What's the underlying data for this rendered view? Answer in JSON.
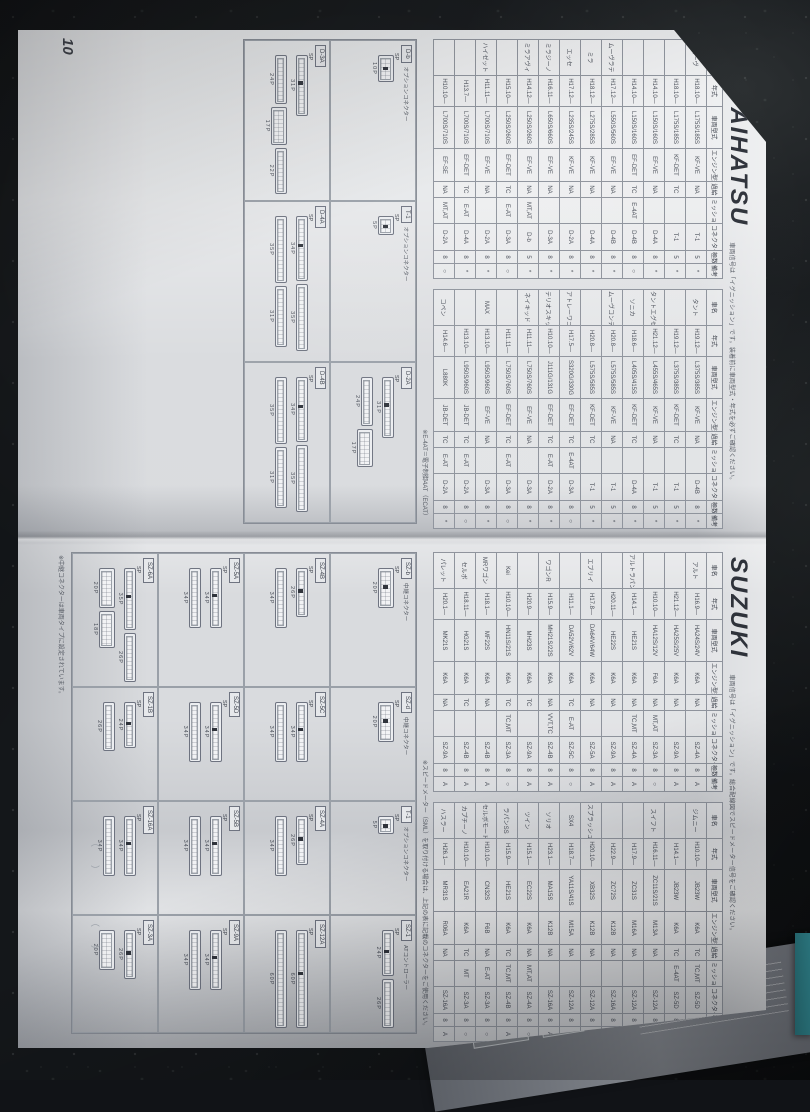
{
  "page": {
    "number": "10",
    "sections": [
      {
        "brand": "DAIHATSU",
        "note": "車両信号は「イグニッション」です。装着前に車両型式・年式を必ずご確認ください。",
        "columns": [
          "車名",
          "年式",
          "車両型式",
          "エンジン型式",
          "過給",
          "ミッション",
          "コネクター",
          "極数",
          "備考"
        ],
        "blocks": [
          [
            [
              "ムーヴ",
              "H18.10—",
              "L175S/185S",
              "KF-VE",
              "NA",
              "",
              "T-1",
              "5",
              "*"
            ],
            [
              "",
              "H18.10—",
              "L175S/185S",
              "KF-DET",
              "TC",
              "",
              "T-1",
              "5",
              "*"
            ],
            [
              "",
              "H14.10—",
              "L150S/160S",
              "EF-VE",
              "NA",
              "",
              "D-4A",
              "8",
              "*"
            ],
            [
              "",
              "H14.10—",
              "L150S/160S",
              "EF-DET",
              "TC",
              "E-4AT",
              "D-4B",
              "8",
              "○"
            ],
            [
              "ムーヴラテ",
              "H17.12—",
              "L550S/560S",
              "EF-VE",
              "NA",
              "",
              "D-4B",
              "8",
              "*"
            ],
            [
              "ミラ",
              "H18.12—",
              "L275S/285S",
              "KF-VE",
              "NA",
              "",
              "D-4A",
              "8",
              "*"
            ],
            [
              "エッセ",
              "H17.12—",
              "L235S/245S",
              "KF-VE",
              "NA",
              "",
              "D-2A",
              "8",
              "*"
            ],
            [
              "ミラジーノ",
              "H16.11—",
              "L650S/660S",
              "EF-VE",
              "NA",
              "",
              "D-3A",
              "8",
              "*"
            ],
            [
              "ミラアヴィ",
              "H14.12—",
              "L250S/260S",
              "EF-VE",
              "NA",
              "MT,AT",
              "D-b",
              "5",
              "*"
            ],
            [
              "",
              "H15.10—",
              "L250S/260S",
              "EF-DET",
              "TC",
              "E-AT",
              "D-3A",
              "8",
              "○"
            ],
            [
              "ハイゼット",
              "H11.11—",
              "L700S/710S",
              "EF-VE",
              "NA",
              "",
              "D-2A",
              "8",
              "*"
            ],
            [
              "",
              "H13.7—",
              "L700S/710S",
              "EF-DET",
              "TC",
              "E-AT",
              "D-4A",
              "8",
              "*"
            ],
            [
              "",
              "H10.10—",
              "L700S/710S",
              "EF-SE",
              "NA",
              "MT,AT",
              "D-2A",
              "8",
              "○"
            ]
          ],
          [
            [
              "タント",
              "H19.12—",
              "L375S/385S",
              "KF-VE",
              "NA",
              "",
              "D-4B",
              "8",
              "*"
            ],
            [
              "",
              "H19.12—",
              "L375S/385S",
              "KF-DET",
              "TC",
              "",
              "T-1",
              "5",
              "*"
            ],
            [
              "タントエグゼ",
              "H21.12—",
              "L455S/465S",
              "KF-VE",
              "NA",
              "",
              "T-1",
              "5",
              "*"
            ],
            [
              "ソニカ",
              "H18.6—",
              "L405S/415S",
              "KF-DET",
              "TC",
              "",
              "D-4A",
              "8",
              "*"
            ],
            [
              "ムーヴコンテ",
              "H20.8—",
              "L575S/585S",
              "KF-VE",
              "NA",
              "",
              "T-1",
              "5",
              "*"
            ],
            [
              "",
              "H20.8—",
              "L575S/585S",
              "KF-DET",
              "TC",
              "",
              "T-1",
              "5",
              "*"
            ],
            [
              "アトレーワゴン",
              "H17.5—",
              "S320G/330G",
              "EF-DET",
              "TC",
              "E-4AT",
              "D-3A",
              "8",
              "○"
            ],
            [
              "テリオスキッド",
              "H10.10—",
              "J111G/131G",
              "EF-DET",
              "TC",
              "E-AT",
              "D-2A",
              "8",
              "*"
            ],
            [
              "ネイキッド",
              "H11.11—",
              "L750S/760S",
              "EF-VE",
              "NA",
              "",
              "D-3A",
              "8",
              "*"
            ],
            [
              "",
              "H11.11—",
              "L750S/760S",
              "EF-DET",
              "TC",
              "E-AT",
              "D-3A",
              "8",
              "○"
            ],
            [
              "MAX",
              "H13.10—",
              "L950S/960S",
              "EF-VE",
              "NA",
              "",
              "D-3A",
              "8",
              "*"
            ],
            [
              "",
              "H13.10—",
              "L950S/960S",
              "JB-DET",
              "TC",
              "E-AT",
              "D-2A",
              "8",
              "○"
            ],
            [
              "コペン",
              "H14.6—",
              "L880K",
              "JB-DET",
              "TC",
              "E-AT",
              "D-2A",
              "8",
              "*"
            ]
          ]
        ],
        "footnote": "※E-4AT＝電子制御4AT（ECAT）",
        "panels": [
          {
            "id": "D-b",
            "sub": "オプションコネクター",
            "rows": [
              [
                "10P"
              ]
            ],
            "sp": "SP"
          },
          {
            "id": "T-1",
            "sub": "オプションコネクター",
            "rows": [
              [
                "5P"
              ]
            ],
            "sp": "SP"
          },
          {
            "id": "D-2A",
            "sub": "",
            "rows": [
              [
                "31P"
              ],
              [
                "24P",
                "17P"
              ]
            ],
            "sp": "SP"
          },
          {
            "id": "D-3A",
            "sub": "",
            "rows": [
              [
                "31P"
              ],
              [
                "24P",
                "17P",
                "22P"
              ]
            ],
            "sp": "SP"
          },
          {
            "id": "D-4A",
            "sub": "",
            "rows": [
              [
                "34P",
                "35P"
              ],
              [
                "35P",
                "31P"
              ]
            ],
            "sp": "SP"
          },
          {
            "id": "D-4B",
            "sub": "",
            "rows": [
              [
                "34P",
                "35P"
              ],
              [
                "35P",
                "31P"
              ]
            ],
            "sp": "SP"
          }
        ]
      },
      {
        "brand": "SUZUKI",
        "note": "車両信号は「イグニッション」です。総合配線図でスピードメーター信号をご確認ください。",
        "columns": [
          "車名",
          "年式",
          "車両型式",
          "エンジン型式",
          "過給",
          "ミッション",
          "コネクター",
          "極数",
          "備考"
        ],
        "blocks": [
          [
            [
              "アルト",
              "H16.9—",
              "HA24S/24V",
              "K6A",
              "NA",
              "",
              "SZ-4A",
              "8",
              "A"
            ],
            [
              "",
              "H21.12—",
              "HA25S/25V",
              "K6A",
              "NA",
              "",
              "SZ-9A",
              "8",
              "A"
            ],
            [
              "",
              "H10.10—",
              "HA12S/12V",
              "F6A",
              "NA",
              "MT,AT",
              "SZ-3A",
              "8",
              "○"
            ],
            [
              "アルトラパン",
              "H14.1—",
              "HE21S",
              "K6A",
              "NA",
              "TC,MT",
              "SZ-4A",
              "8",
              "A"
            ],
            [
              "",
              "H20.11—",
              "HE22S",
              "K6A",
              "NA",
              "",
              "SZ-9A",
              "8",
              "A"
            ],
            [
              "エブリイ",
              "H17.8—",
              "DA64V/64W",
              "K6A",
              "NA",
              "",
              "SZ-5A",
              "8",
              "A"
            ],
            [
              "",
              "H11.1—",
              "DA52V/62V",
              "K6A",
              "TC",
              "E-AT",
              "SZ-5C",
              "8",
              "○"
            ],
            [
              "ワゴンR",
              "H15.9—",
              "MH21S/22S",
              "K6A",
              "NA",
              "VVT,TC",
              "SZ-4B",
              "8",
              "A"
            ],
            [
              "",
              "H20.9—",
              "MH23S",
              "K6A",
              "TC",
              "",
              "SZ-9A",
              "8",
              "A"
            ],
            [
              "Kei",
              "H10.10—",
              "HN11S/21S",
              "K6A",
              "TC",
              "TC,MT",
              "SZ-3A",
              "8",
              "○"
            ],
            [
              "MRワゴン",
              "H18.1—",
              "MF22S",
              "K6A",
              "NA",
              "",
              "SZ-4B",
              "8",
              "A"
            ],
            [
              "セルボ",
              "H18.11—",
              "HG21S",
              "K6A",
              "TC",
              "",
              "SZ-4B",
              "8",
              "A"
            ],
            [
              "パレット",
              "H20.1—",
              "MK21S",
              "K6A",
              "NA",
              "",
              "SZ-9A",
              "8",
              "A"
            ]
          ],
          [
            [
              "ジムニー",
              "H10.10—",
              "JB23W",
              "K6A",
              "TC",
              "TC,MT",
              "SZ-5D",
              "8",
              "A"
            ],
            [
              "",
              "H14.1—",
              "JB23W",
              "K6A",
              "TC",
              "E-4AT",
              "SZ-5D",
              "8",
              "○"
            ],
            [
              "スイフト",
              "H16.11—",
              "ZC11S/21S",
              "M13A",
              "NA",
              "",
              "SZ-12A",
              "8",
              "A"
            ],
            [
              "",
              "H17.9—",
              "ZC31S",
              "M16A",
              "NA",
              "",
              "SZ-12A",
              "8",
              "A"
            ],
            [
              "",
              "H22.9—",
              "ZC72S",
              "K12B",
              "NA",
              "",
              "SZ-16A",
              "8",
              "A"
            ],
            [
              "スプラッシュ",
              "H20.10—",
              "XB32S",
              "K12B",
              "NA",
              "",
              "SZ-12A",
              "8",
              "A"
            ],
            [
              "SX4",
              "H18.7—",
              "YA11S/41S",
              "M15A",
              "NA",
              "",
              "SZ-12A",
              "8",
              "A"
            ],
            [
              "ソリオ",
              "H23.1—",
              "MA15S",
              "K12B",
              "NA",
              "",
              "SZ-16A",
              "8",
              "A"
            ],
            [
              "ツイン",
              "H15.1—",
              "EC22S",
              "K6A",
              "NA",
              "MT,AT",
              "SZ-4A",
              "8",
              "○"
            ],
            [
              "ラパンSS",
              "H15.9—",
              "HE21S",
              "K6A",
              "TC",
              "TC,MT",
              "SZ-4B",
              "8",
              "A"
            ],
            [
              "セルボモード",
              "H10.10—",
              "CN32S",
              "F6B",
              "NA",
              "E-AT",
              "SZ-3A",
              "8",
              "○"
            ],
            [
              "カプチーノ",
              "H10.10—",
              "EA21R",
              "K6A",
              "TC",
              "MT",
              "SZ-3A",
              "8",
              "○"
            ],
            [
              "ハスラー",
              "H26.1—",
              "MR31S",
              "R06A",
              "NA",
              "",
              "SZ-16A",
              "8",
              "A"
            ]
          ]
        ],
        "footnote": "※スピードメーター（SML）を取り付ける場合は、上記の表に記載のコネクターをご使用ください。",
        "bottom_note": "※中継コネクターは車両タイプに設定されています。",
        "brackets": [
          "（　　）",
          "（　　）"
        ],
        "panels": [
          {
            "id": "SZ-b",
            "sub": "中継コネクター",
            "rows": [
              [
                "20P"
              ]
            ],
            "sp": "SP"
          },
          {
            "id": "SZ-d",
            "sub": "中継コネクター",
            "rows": [
              [
                "20P"
              ]
            ],
            "sp": "SP"
          },
          {
            "id": "T-1",
            "sub": "オプションコネクター",
            "rows": [
              [
                "5P"
              ]
            ],
            "sp": "SP"
          },
          {
            "id": "SZ-1",
            "sub": "ATコントローラー",
            "rows": [
              [
                "24P",
                "26P"
              ]
            ],
            "sp": "SP"
          },
          {
            "id": "SZ-4B",
            "sub": "",
            "rows": [
              [
                "26P"
              ],
              [
                "34P"
              ]
            ],
            "sp": "SP"
          },
          {
            "id": "SZ-5C",
            "sub": "",
            "rows": [
              [
                "34P"
              ],
              [
                "34P"
              ]
            ],
            "sp": "SP"
          },
          {
            "id": "SZ-4A",
            "sub": "",
            "rows": [
              [
                "26P"
              ],
              [
                "34P"
              ]
            ],
            "sp": "SP"
          },
          {
            "id": "SZ-12A",
            "sub": "",
            "rows": [
              [
                "60P"
              ],
              [
                "60P"
              ]
            ],
            "sp": "SP"
          },
          {
            "id": "SZ-5A",
            "sub": "",
            "rows": [
              [
                "34P"
              ],
              [
                "34P"
              ]
            ],
            "sp": "SP"
          },
          {
            "id": "SZ-5D",
            "sub": "",
            "rows": [
              [
                "34P"
              ],
              [
                "34P"
              ]
            ],
            "sp": "SP"
          },
          {
            "id": "SZ-5B",
            "sub": "",
            "rows": [
              [
                "34P"
              ],
              [
                "34P"
              ]
            ],
            "sp": "SP"
          },
          {
            "id": "SZ-9A",
            "sub": "",
            "rows": [
              [
                "34P"
              ],
              [
                "34P"
              ]
            ],
            "sp": "SP"
          },
          {
            "id": "SZ-6A",
            "sub": "",
            "rows": [
              [
                "35P",
                "26P"
              ],
              [
                "20P",
                "18P"
              ]
            ],
            "sp": "SP"
          },
          {
            "id": "SZ-1B",
            "sub": "",
            "rows": [
              [
                "24P"
              ],
              [
                "26P"
              ]
            ],
            "sp": "SP"
          },
          {
            "id": "SZ-16A",
            "sub": "",
            "rows": [
              [
                "34P"
              ],
              [
                "34P"
              ]
            ],
            "sp": "SP"
          },
          {
            "id": "SZ-3A",
            "sub": "",
            "rows": [
              [
                "26P"
              ],
              [
                "20P"
              ]
            ],
            "sp": "SP"
          }
        ]
      }
    ]
  },
  "colors": {
    "paper": "#d9dbde",
    "granite": "#14171a",
    "teal_print": "#2c7b84",
    "ink": "#4a4f59"
  }
}
